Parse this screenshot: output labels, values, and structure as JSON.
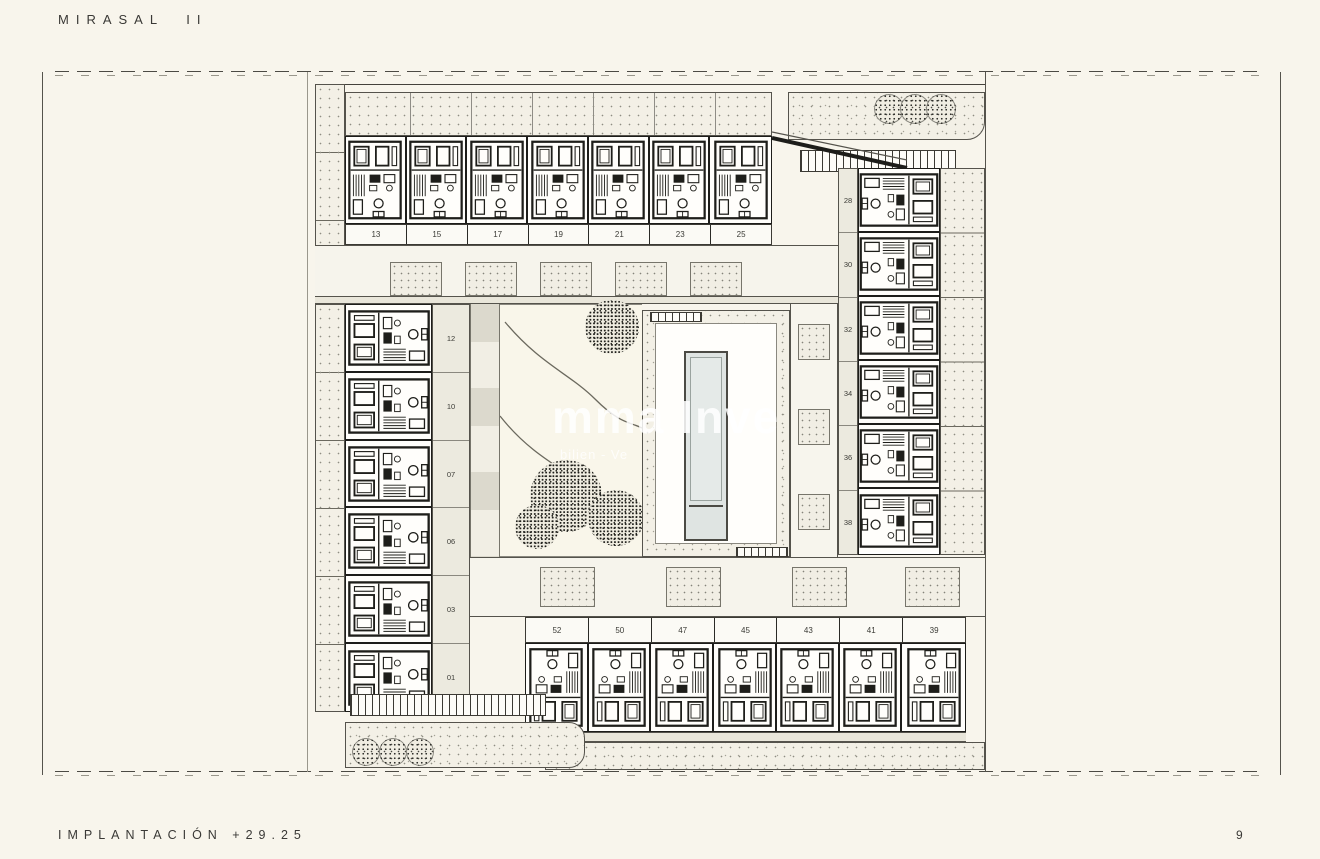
{
  "header": {
    "title": "MIRASAL II"
  },
  "footer": {
    "label": "IMPLANTACIÓN +29.25",
    "page_number": "9"
  },
  "watermark": {
    "line1": "mma Inve",
    "line2": "bilien - Ve"
  },
  "plan": {
    "top_row": {
      "units": [
        "13",
        "15",
        "17",
        "19",
        "21",
        "23",
        "25"
      ]
    },
    "right_col": {
      "units": [
        "28",
        "30",
        "32",
        "34",
        "36",
        "38"
      ]
    },
    "left_col": {
      "units": [
        "12",
        "10",
        "07",
        "06",
        "03",
        "01"
      ]
    },
    "bottom_row": {
      "units": [
        "52",
        "50",
        "47",
        "45",
        "43",
        "41",
        "39"
      ]
    }
  },
  "colors": {
    "page_background": "#f8f5ec",
    "drawing_line": "#1d1d1a",
    "pool_water": "#dfe4e2",
    "stipple_dot": "#8f8d82",
    "watermark": "#ffffff"
  }
}
